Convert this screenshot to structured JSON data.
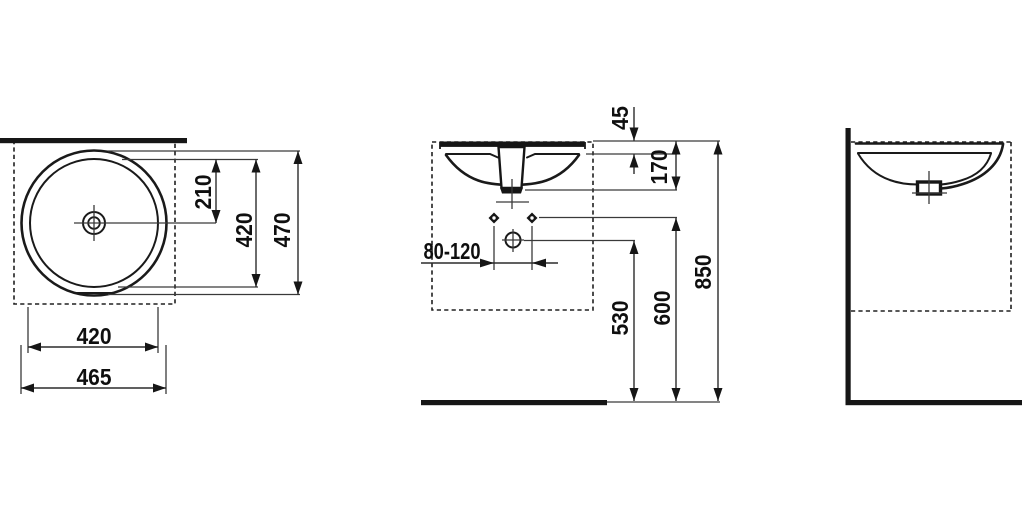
{
  "drawing": {
    "type": "washbasin installation dimension drawing",
    "colors": {
      "background": "#ffffff",
      "lines": "#1a1a1a",
      "dimension_lines": "#2c2c2c",
      "text": "#0f0f0f"
    },
    "views": {
      "top": {
        "dims": {
          "center_from_back": "210",
          "inner_depth": "420",
          "overall_depth": "470",
          "inner_width": "420",
          "overall_width": "465"
        }
      },
      "front": {
        "dims": {
          "rim_thickness": "45",
          "basin_height": "170",
          "trap_offset_range": "80-120",
          "drain_height": "530",
          "fixing_holes_height": "600",
          "rim_top_height": "850"
        }
      }
    }
  }
}
